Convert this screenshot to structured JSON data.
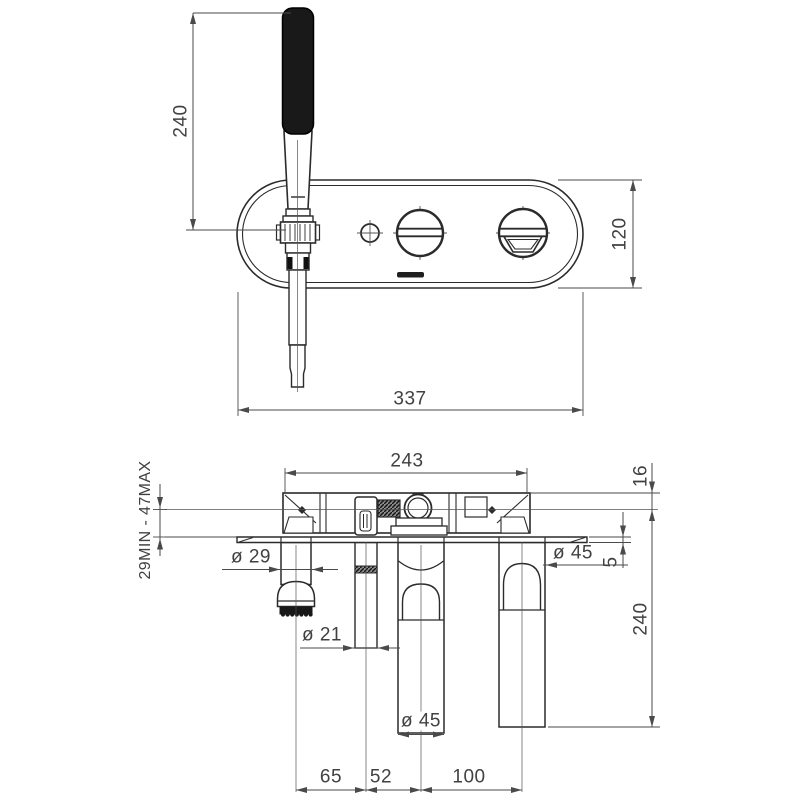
{
  "drawing": {
    "front_view": {
      "hose_height": "240",
      "plate_height": "120",
      "plate_width": "337"
    },
    "section_view": {
      "body_width": "243",
      "wall_depth_range": "29MIN - 47MAX",
      "trim_depth": "16",
      "plate_thickness": "5",
      "drop_length": "240",
      "holder_diameter": "ø 29",
      "pin_diameter": "ø 21",
      "spout_diameter": "ø 45",
      "handle_diameter": "ø 45",
      "spacing_left": "65",
      "spacing_center": "52",
      "spacing_right": "100"
    }
  }
}
